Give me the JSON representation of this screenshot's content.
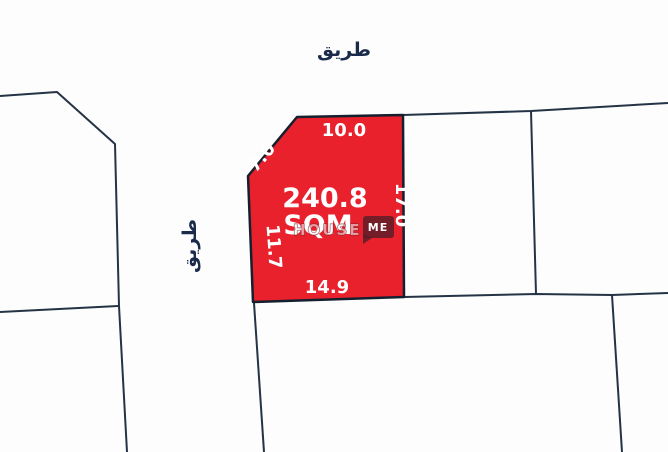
{
  "map": {
    "roads": {
      "top_label": "طريق",
      "left_label": "طريق"
    },
    "plot": {
      "area_value": "240.8",
      "area_unit": "SQM",
      "dimensions": {
        "top": "10.0",
        "diagonal": "7.0",
        "right": "17.0",
        "left": "11.7",
        "bottom": "14.9"
      }
    },
    "watermark": {
      "part1": "HOUSE",
      "part2": "ME"
    },
    "colors": {
      "plot_fill": "#e8212d",
      "plot_border": "#15202f",
      "boundary": "#243345",
      "road_text": "#1a2a4a",
      "badge_fill": "rgba(88,28,38,0.82)"
    }
  }
}
